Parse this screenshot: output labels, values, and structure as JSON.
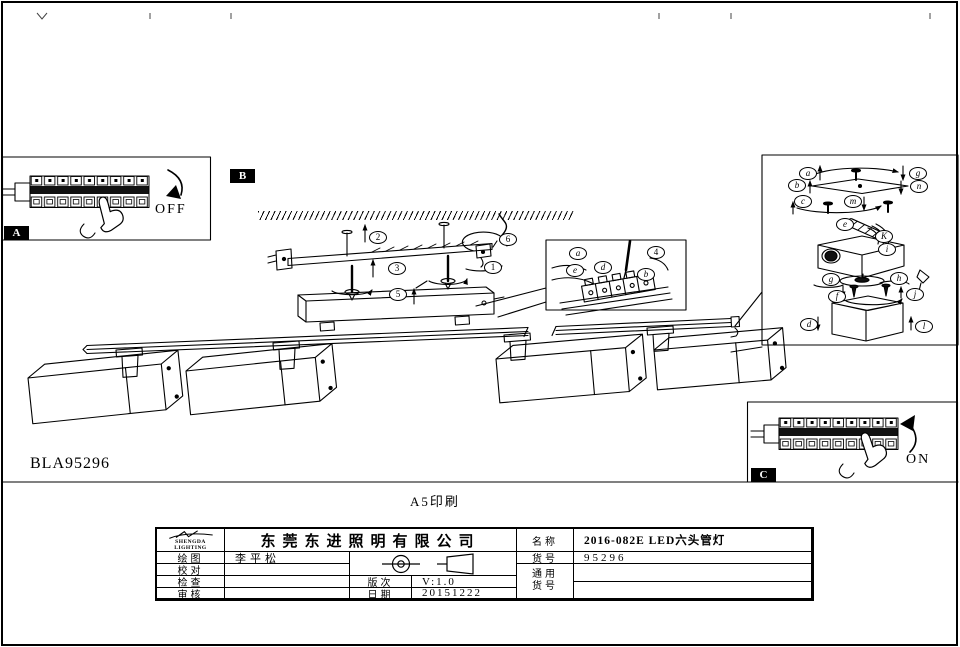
{
  "sheet": {
    "code": "BLA95296",
    "print_note": "A5印刷"
  },
  "badges": {
    "a": "A",
    "b": "B",
    "c": "C"
  },
  "switch": {
    "off": "OFF",
    "on": "ON"
  },
  "steps": {
    "s1": "1",
    "s2": "2",
    "s3": "3",
    "s4": "4",
    "s5": "5",
    "s6": "6"
  },
  "detail": {
    "a": "a",
    "e": "e",
    "d": "d",
    "b": "b"
  },
  "exploded": {
    "a": "a",
    "g": "g",
    "b": "b",
    "n": "n",
    "c": "c",
    "m": "m",
    "e": "e",
    "k": "K",
    "i": "i",
    "g2": "g",
    "h": "h",
    "f": "f",
    "j": "j",
    "d": "d",
    "l": "l"
  },
  "title_block": {
    "logo_line1": "SHENGDA",
    "logo_line2": "LIGHTING",
    "company": "东莞东进照明有限公司",
    "draw_label": "绘图",
    "draw_value": "李平松",
    "proof_label": "校对",
    "inspect_label": "检查",
    "review_label": "审核",
    "version_label": "版次",
    "version_value": "V:1.0",
    "date_label": "日期",
    "date_value": "20151222",
    "name_label": "名称",
    "name_value": "2016-082E LED六头管灯",
    "item_label": "货号",
    "item_value": "95296",
    "common_label_1": "通用",
    "common_label_2": "货号"
  }
}
